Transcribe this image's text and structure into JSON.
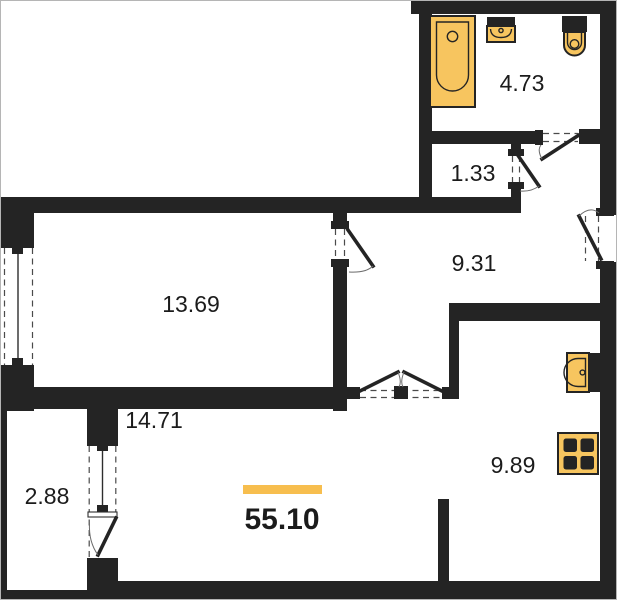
{
  "floor_plan": {
    "total": {
      "area": "55.10"
    },
    "rooms": [
      {
        "name": "bathroom",
        "area": "4.73"
      },
      {
        "name": "storage",
        "area": "1.33"
      },
      {
        "name": "hallway",
        "area": "9.31"
      },
      {
        "name": "bedroom",
        "area": "13.69"
      },
      {
        "name": "living-room",
        "area": "14.71"
      },
      {
        "name": "balcony",
        "area": "2.88"
      },
      {
        "name": "kitchen",
        "area": "9.89"
      }
    ],
    "fixtures": [
      "bathtub-icon",
      "bathroom-sink-icon",
      "toilet-icon",
      "kitchen-sink-icon",
      "stove-icon"
    ],
    "colors": {
      "wall": "#242424",
      "fixture": "#F7C55F",
      "accent": "#F7BE4E",
      "text": "#1B1B1B",
      "background": "#FFFFFF"
    }
  }
}
